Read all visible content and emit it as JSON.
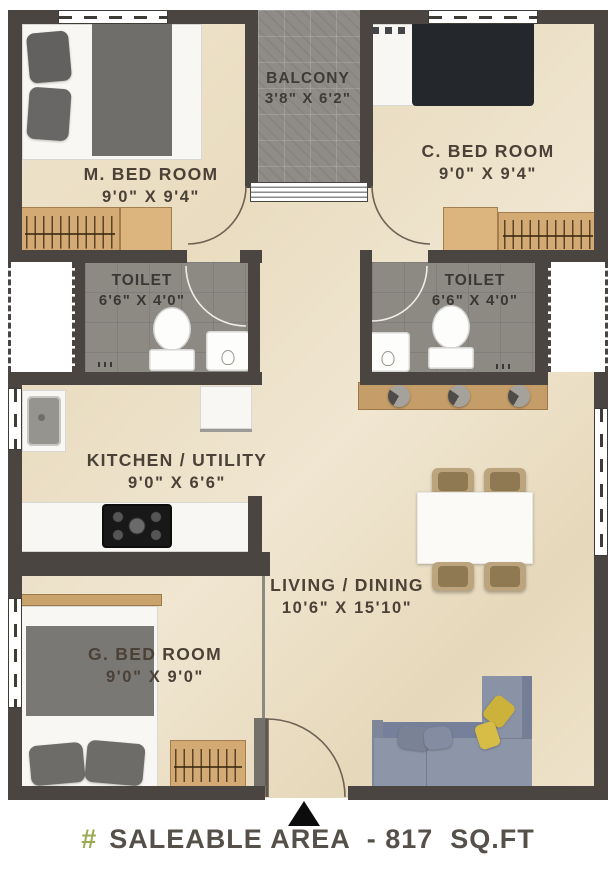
{
  "rooms": {
    "m_bedroom": {
      "name": "M. BED ROOM",
      "dims": "9'0\" X 9'4\""
    },
    "balcony": {
      "name": "BALCONY",
      "dims": "3'8\" X 6'2\""
    },
    "c_bedroom": {
      "name": "C. BED ROOM",
      "dims": "9'0\" X 9'4\""
    },
    "toilet_left": {
      "name": "TOILET",
      "dims": "6'6\" X 4'0\""
    },
    "toilet_right": {
      "name": "TOILET",
      "dims": "6'6\" X 4'0\""
    },
    "kitchen": {
      "name": "KITCHEN / UTILITY",
      "dims": "9'0\" X 6'6\""
    },
    "living": {
      "name": "LIVING / DINING",
      "dims": "10'6\" X 15'10\""
    },
    "g_bedroom": {
      "name": "G. BED ROOM",
      "dims": "9'0\" X 9'0\""
    }
  },
  "footer": {
    "hash": "#",
    "text": "SALEABLE AREA  - 817  SQ.FT"
  },
  "colors": {
    "wall": "#4a4540",
    "floor": "#ecdfc5",
    "tile_gray": "#8f8c88",
    "wood": "#d3aa74",
    "sofa": "#8d95a9",
    "bed_dark": "#24282d",
    "accent_green": "#9cab52",
    "label_text": "#4b4137"
  }
}
